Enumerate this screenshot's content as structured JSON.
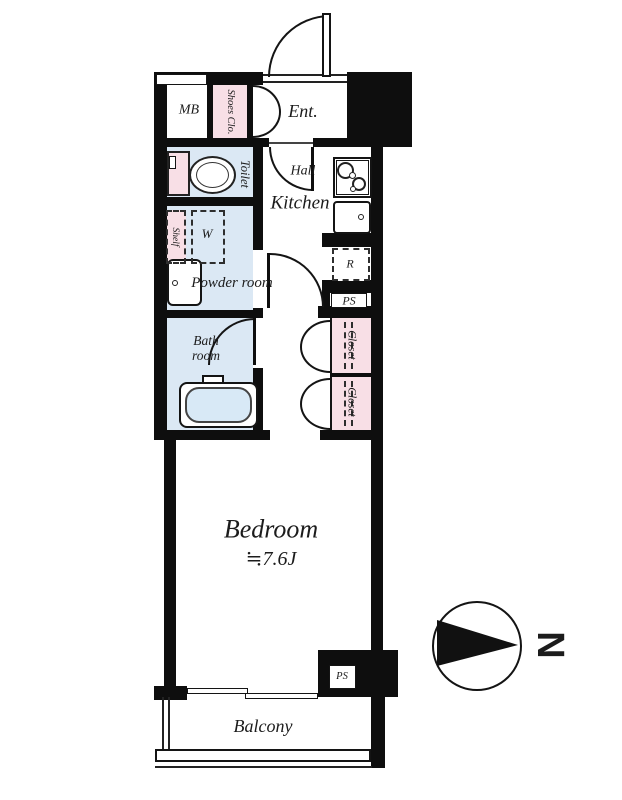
{
  "floorplan": {
    "type": "apartment-floor-plan",
    "labels": {
      "mb": "MB",
      "shoes_closet": "Shoes Clo.",
      "entrance": "Ent.",
      "toilet": "Toilet",
      "hall": "Hall",
      "kitchen": "Kitchen",
      "shelf": "Shelf",
      "washer": "W",
      "powder_room": "Powder room",
      "refrigerator": "R",
      "pipe_space_upper": "PS",
      "bath_room": "Bath room",
      "closet_upper": "Closet",
      "closet_lower": "Closet",
      "bedroom": "Bedroom",
      "bedroom_size": "≒7.6J",
      "pipe_space_lower": "PS",
      "balcony": "Balcony",
      "north": "N"
    },
    "colors": {
      "wall": "#0e0e0e",
      "water_room_fill": "#dbe8f4",
      "closet_fill": "#f8dfe6",
      "tub_fill": "#d8e9f6",
      "text": "#1c1c1c"
    }
  }
}
